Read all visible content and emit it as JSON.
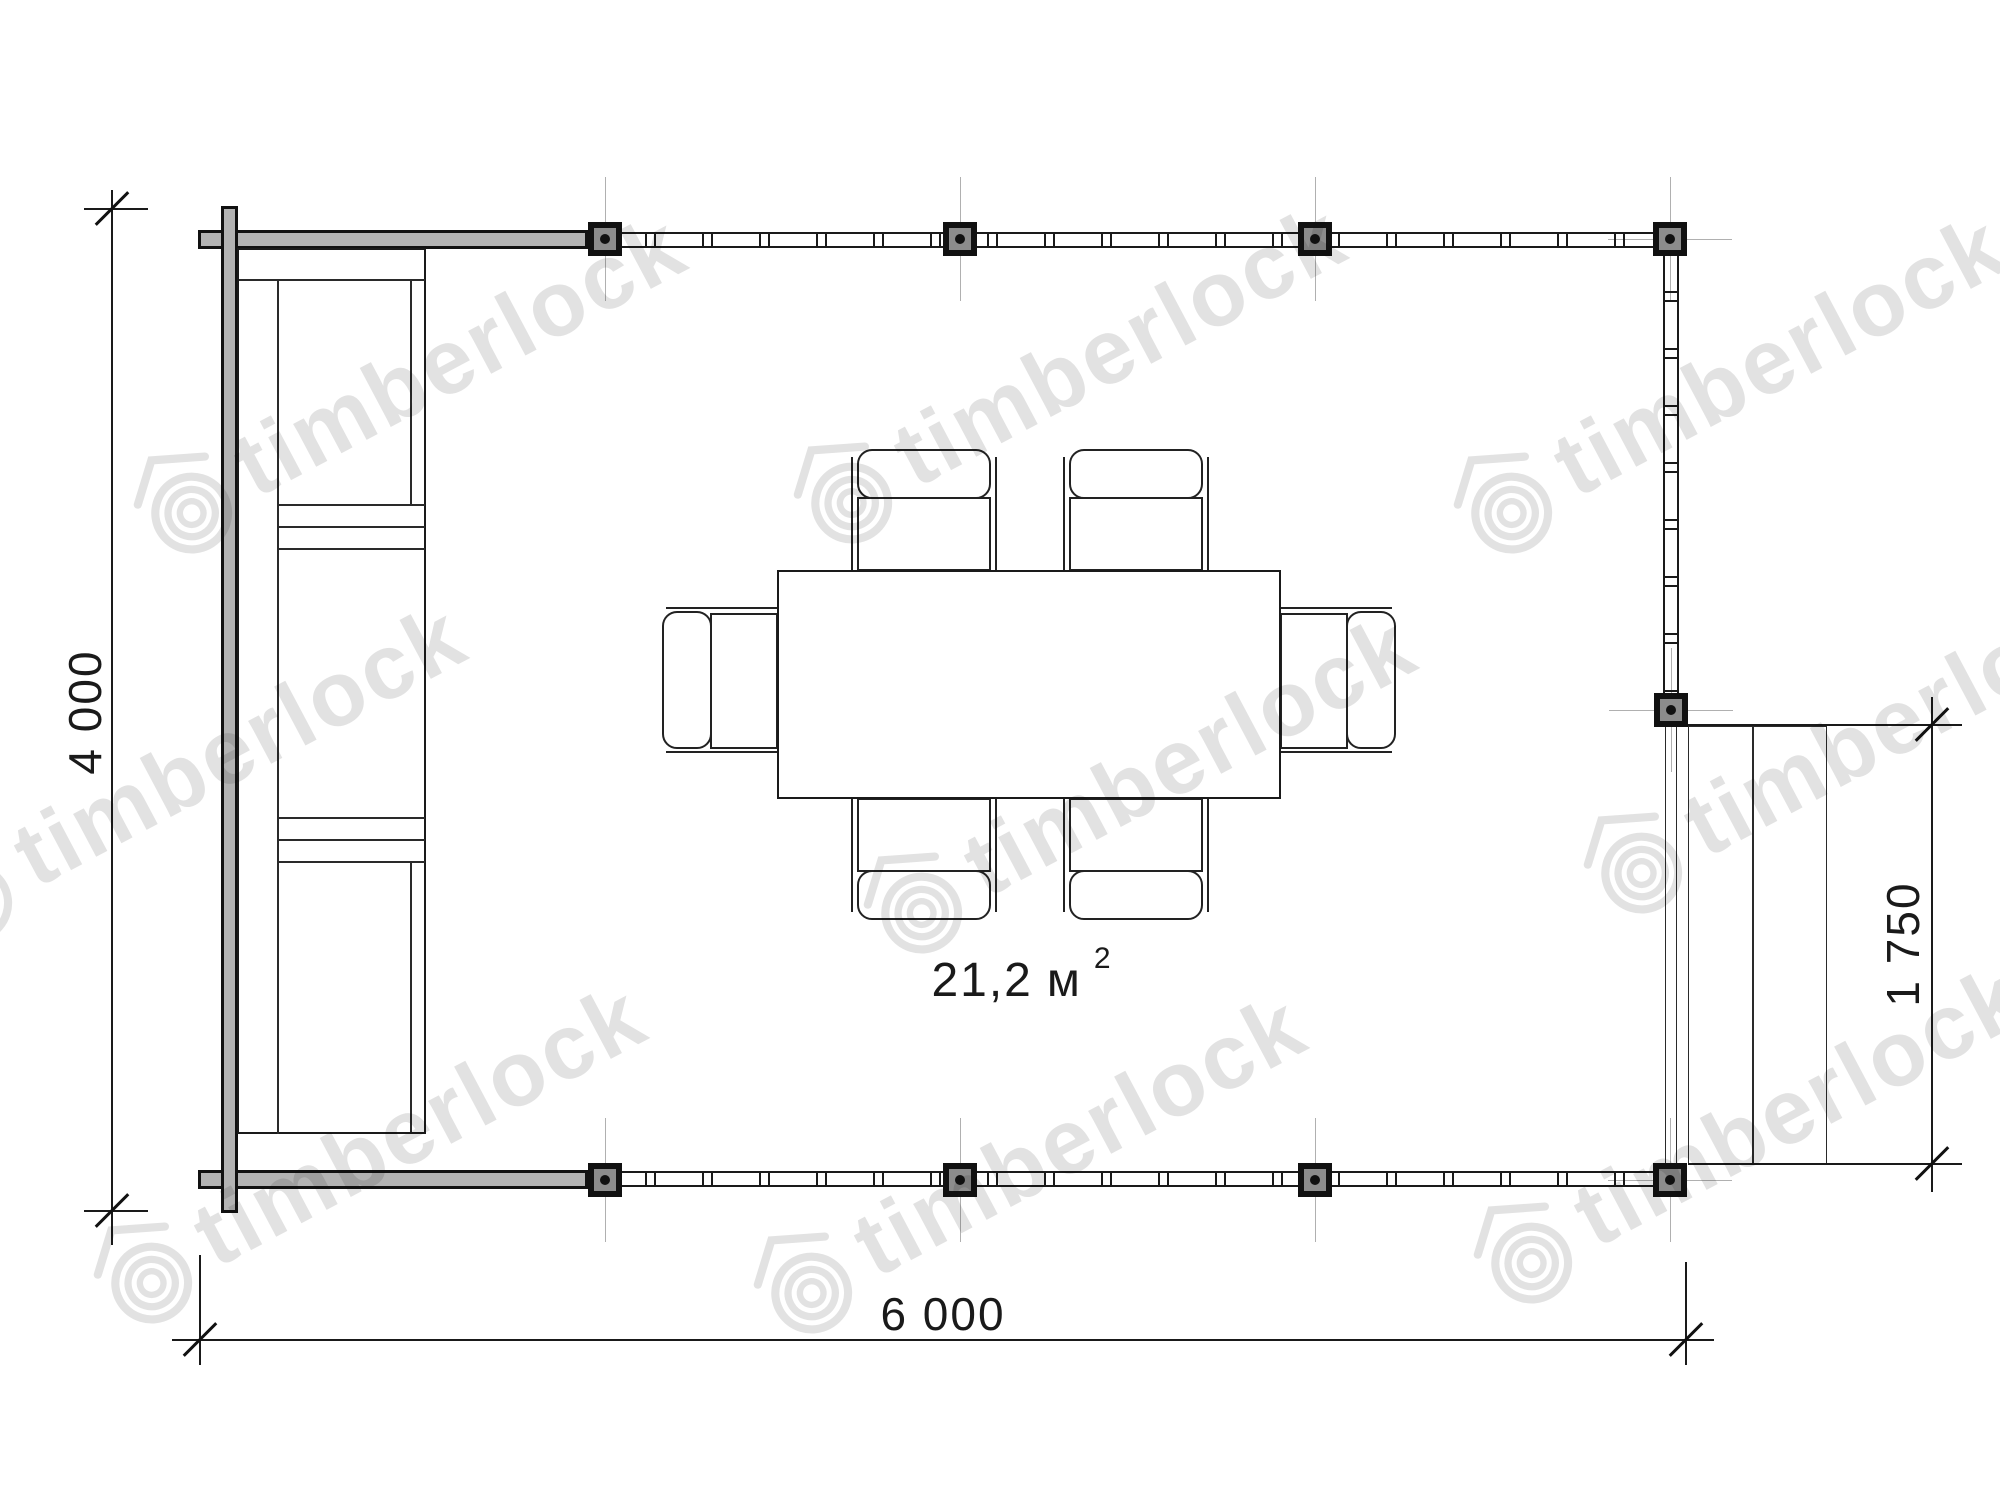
{
  "page": {
    "background": "#ffffff"
  },
  "watermark": {
    "text": "timberlock",
    "color": "#c6c6c6",
    "tiles": [
      {
        "x": 340,
        "y": 400
      },
      {
        "x": 1000,
        "y": 390
      },
      {
        "x": 1660,
        "y": 400
      },
      {
        "x": 120,
        "y": 790
      },
      {
        "x": 1070,
        "y": 800
      },
      {
        "x": 1790,
        "y": 760
      },
      {
        "x": 300,
        "y": 1170
      },
      {
        "x": 960,
        "y": 1180
      },
      {
        "x": 1680,
        "y": 1150
      }
    ]
  },
  "dimensions": {
    "height_label": "4 000",
    "width_label": "6 000",
    "porch_label": "1 750"
  },
  "area_label": {
    "value": "21,2",
    "unit": "м",
    "superscript": "2"
  },
  "plan": {
    "colors": {
      "line": "#1a1a1a",
      "beam_fill": "#b3b3b3",
      "post_fill": "#8c8c8c",
      "centerline": "#b0b0b0"
    },
    "posts": [
      {
        "x": 605,
        "y": 239,
        "cl": "v"
      },
      {
        "x": 960,
        "y": 239,
        "cl": "v"
      },
      {
        "x": 1315,
        "y": 239,
        "cl": "v"
      },
      {
        "x": 1670,
        "y": 239,
        "cl": "vh"
      },
      {
        "x": 1671,
        "y": 710,
        "cl": "vh"
      },
      {
        "x": 605,
        "y": 1180,
        "cl": "v"
      },
      {
        "x": 960,
        "y": 1180,
        "cl": "v"
      },
      {
        "x": 1315,
        "y": 1180,
        "cl": "v"
      },
      {
        "x": 1670,
        "y": 1180,
        "cl": "vh"
      }
    ]
  }
}
